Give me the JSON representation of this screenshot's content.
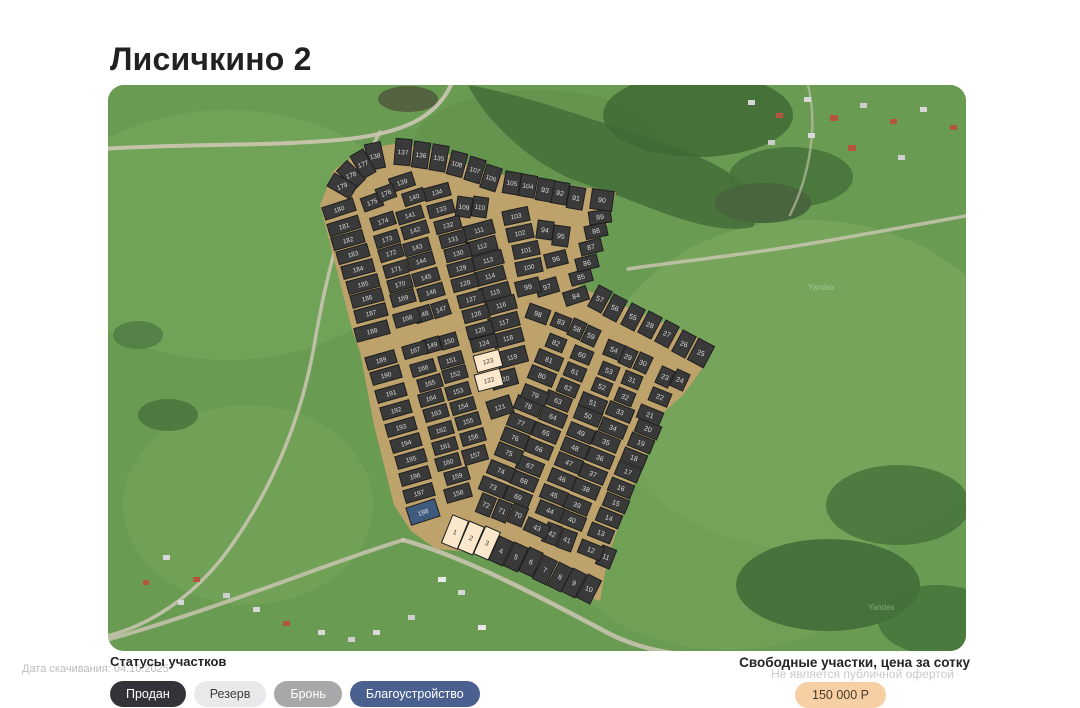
{
  "page": {
    "title": "Лисичкино 2"
  },
  "footer": {
    "download_date_label": "Дата скачивания: 04.10.2025",
    "legend_title": "Статусы участков",
    "statuses": [
      {
        "id": "sold",
        "label": "Продан",
        "bg": "#333339",
        "fg": "#ffffff"
      },
      {
        "id": "reserve",
        "label": "Резерв",
        "bg": "#e9e9ec",
        "fg": "#3c3c3c"
      },
      {
        "id": "hold",
        "label": "Бронь",
        "bg": "#a8a8aa",
        "fg": "#ffffff"
      },
      {
        "id": "improvement",
        "label": "Благоустройство",
        "bg": "#4a6190",
        "fg": "#ffffff"
      }
    ],
    "price_title": "Свободные участки, цена за сотку",
    "price_disclaimer": "Не является публичной офертой",
    "price_badge": "150 000 Р",
    "price_badge_bg": "#f6d0a4"
  },
  "map": {
    "watermark": "Yandex",
    "colors": {
      "road": "#bda26c",
      "stroke": "#1f1f1f",
      "sold": "#3a3a3b",
      "sold_text": "#dcdcdc",
      "free": "#fbe8cc",
      "free_text": "#433d33",
      "improvement": "#3e5a7c",
      "improvement_text": "#dde4ee"
    },
    "free_plots": [
      1,
      2,
      3,
      122,
      123
    ],
    "improvement_plots": [
      198
    ],
    "outline": "212,120 226,85 256,64 292,58 348,71 365,84 390,89 508,107 500,139 475,178 471,204 484,207 602,258 596,281 576,309 554,329 526,398 500,471 492,516 465,507 385,474 374,468 328,464 303,446 286,420 266,340 252,267 245,248",
    "plots": [
      [
        1,
        347,
        447,
        22,
        17,
        30
      ],
      [
        2,
        363,
        453,
        23,
        16,
        30
      ],
      [
        3,
        379,
        458,
        24,
        16,
        30
      ],
      [
        4,
        393,
        466,
        25,
        15,
        26
      ],
      [
        5,
        408,
        472,
        25,
        15,
        26
      ],
      [
        6,
        423,
        477,
        25,
        15,
        26
      ],
      [
        7,
        437,
        485,
        26,
        15,
        26
      ],
      [
        8,
        452,
        492,
        27,
        15,
        26
      ],
      [
        9,
        466,
        498,
        27,
        15,
        26
      ],
      [
        10,
        481,
        504,
        27,
        15,
        26
      ],
      [
        11,
        498,
        472,
        22,
        15,
        20
      ],
      [
        12,
        483,
        465,
        22,
        24,
        14
      ],
      [
        13,
        493,
        448,
        22,
        24,
        14
      ],
      [
        14,
        501,
        433,
        22,
        24,
        14
      ],
      [
        15,
        508,
        418,
        22,
        24,
        14
      ],
      [
        16,
        513,
        403,
        22,
        24,
        14
      ],
      [
        17,
        520,
        387,
        22,
        24,
        14
      ],
      [
        18,
        526,
        373,
        22,
        24,
        14
      ],
      [
        19,
        533,
        358,
        22,
        24,
        14
      ],
      [
        20,
        540,
        344,
        22,
        24,
        14
      ],
      [
        21,
        542,
        330,
        22,
        24,
        14
      ],
      [
        22,
        552,
        312,
        22,
        20,
        14
      ],
      [
        23,
        557,
        292,
        25,
        14,
        18
      ],
      [
        24,
        572,
        295,
        25,
        14,
        18
      ],
      [
        25,
        593,
        268,
        28,
        18,
        24
      ],
      [
        26,
        576,
        259,
        28,
        15,
        24
      ],
      [
        27,
        559,
        249,
        28,
        15,
        24
      ],
      [
        28,
        542,
        240,
        28,
        15,
        24
      ],
      [
        29,
        520,
        272,
        25,
        14,
        18
      ],
      [
        30,
        535,
        278,
        25,
        14,
        18
      ],
      [
        31,
        524,
        295,
        22,
        18,
        14
      ],
      [
        32,
        517,
        312,
        22,
        18,
        14
      ],
      [
        33,
        512,
        327,
        22,
        26,
        14
      ],
      [
        34,
        505,
        343,
        22,
        26,
        14
      ],
      [
        35,
        498,
        357,
        22,
        26,
        14
      ],
      [
        36,
        492,
        373,
        22,
        26,
        14
      ],
      [
        37,
        485,
        389,
        22,
        26,
        14
      ],
      [
        38,
        478,
        404,
        22,
        26,
        14
      ],
      [
        39,
        469,
        420,
        22,
        26,
        14
      ],
      [
        40,
        464,
        435,
        22,
        26,
        14
      ],
      [
        41,
        459,
        455,
        20,
        15,
        20
      ],
      [
        42,
        444,
        449,
        20,
        15,
        20
      ],
      [
        43,
        429,
        443,
        24,
        24,
        14
      ],
      [
        44,
        442,
        426,
        22,
        26,
        14
      ],
      [
        45,
        446,
        410,
        22,
        26,
        14
      ],
      [
        46,
        454,
        394,
        22,
        26,
        14
      ],
      [
        47,
        461,
        378,
        22,
        26,
        14
      ],
      [
        48,
        467,
        363,
        22,
        26,
        14
      ],
      [
        49,
        473,
        348,
        22,
        26,
        14
      ],
      [
        50,
        480,
        331,
        22,
        26,
        14
      ],
      [
        51,
        485,
        318,
        22,
        26,
        14
      ],
      [
        52,
        494,
        302,
        22,
        18,
        14
      ],
      [
        53,
        501,
        286,
        22,
        18,
        14
      ],
      [
        54,
        506,
        265,
        22,
        18,
        16
      ],
      [
        55,
        525,
        232,
        28,
        15,
        24
      ],
      [
        56,
        507,
        223,
        28,
        15,
        24
      ],
      [
        57,
        492,
        214,
        28,
        15,
        24
      ],
      [
        58,
        469,
        244,
        25,
        14,
        18
      ],
      [
        59,
        483,
        251,
        25,
        14,
        18
      ],
      [
        60,
        474,
        270,
        22,
        20,
        14
      ],
      [
        61,
        467,
        287,
        22,
        20,
        14
      ],
      [
        62,
        460,
        303,
        22,
        20,
        14
      ],
      [
        63,
        450,
        316,
        22,
        26,
        14
      ],
      [
        64,
        445,
        332,
        22,
        26,
        14
      ],
      [
        65,
        438,
        348,
        22,
        26,
        14
      ],
      [
        66,
        431,
        364,
        22,
        26,
        14
      ],
      [
        67,
        422,
        381,
        22,
        26,
        14
      ],
      [
        68,
        416,
        396,
        22,
        26,
        14
      ],
      [
        69,
        410,
        412,
        22,
        26,
        14
      ],
      [
        70,
        410,
        430,
        22,
        15,
        20
      ],
      [
        71,
        394,
        426,
        22,
        15,
        20
      ],
      [
        72,
        378,
        420,
        22,
        15,
        20
      ],
      [
        73,
        385,
        402,
        22,
        26,
        14
      ],
      [
        74,
        393,
        386,
        22,
        26,
        14
      ],
      [
        75,
        401,
        368,
        22,
        26,
        14
      ],
      [
        76,
        407,
        353,
        22,
        26,
        14
      ],
      [
        77,
        413,
        338,
        22,
        26,
        14
      ],
      [
        78,
        420,
        321,
        22,
        26,
        14
      ],
      [
        79,
        427,
        310,
        22,
        26,
        14
      ],
      [
        80,
        434,
        291,
        22,
        26,
        14
      ],
      [
        81,
        441,
        275,
        22,
        26,
        14
      ],
      [
        82,
        448,
        258,
        22,
        18,
        14
      ],
      [
        83,
        453,
        237,
        22,
        18,
        14
      ],
      [
        84,
        468,
        211,
        -18,
        24,
        14
      ],
      [
        85,
        473,
        192,
        -16,
        22,
        13
      ],
      [
        86,
        479,
        178,
        -14,
        22,
        13
      ],
      [
        87,
        483,
        162,
        -14,
        22,
        13
      ],
      [
        88,
        488,
        146,
        -12,
        22,
        13
      ],
      [
        89,
        492,
        132,
        -8,
        22,
        13
      ],
      [
        90,
        494,
        115,
        8,
        22,
        20
      ],
      [
        91,
        468,
        113,
        10,
        16,
        22
      ],
      [
        92,
        452,
        108,
        10,
        16,
        22
      ],
      [
        93,
        437,
        105,
        10,
        16,
        22
      ],
      [
        94,
        437,
        145,
        8,
        16,
        18
      ],
      [
        95,
        453,
        151,
        8,
        16,
        20
      ],
      [
        96,
        448,
        174,
        -14,
        22,
        14
      ],
      [
        97,
        439,
        202,
        -16,
        22,
        15
      ],
      [
        98,
        430,
        229,
        20,
        22,
        15
      ],
      [
        99,
        420,
        202,
        -14,
        24,
        15
      ],
      [
        100,
        421,
        182,
        -12,
        26,
        14
      ],
      [
        101,
        418,
        165,
        -12,
        26,
        14
      ],
      [
        102,
        412,
        148,
        -12,
        26,
        14
      ],
      [
        103,
        408,
        131,
        -12,
        26,
        14
      ],
      [
        104,
        420,
        101,
        10,
        16,
        22
      ],
      [
        105,
        404,
        98,
        10,
        16,
        22
      ],
      [
        106,
        383,
        93,
        18,
        16,
        24
      ],
      [
        107,
        367,
        85,
        17,
        16,
        24
      ],
      [
        108,
        349,
        79,
        15,
        16,
        24
      ],
      [
        109,
        356,
        122,
        8,
        15,
        20
      ],
      [
        110,
        372,
        122,
        8,
        15,
        20
      ],
      [
        111,
        371,
        145,
        -15,
        30,
        14
      ],
      [
        112,
        374,
        161,
        -15,
        30,
        14
      ],
      [
        113,
        380,
        175,
        -15,
        30,
        14
      ],
      [
        114,
        382,
        191,
        -15,
        30,
        14
      ],
      [
        115,
        387,
        207,
        -15,
        30,
        14
      ],
      [
        116,
        393,
        220,
        -15,
        30,
        14
      ],
      [
        117,
        396,
        237,
        -15,
        30,
        14
      ],
      [
        118,
        400,
        253,
        -15,
        30,
        14
      ],
      [
        119,
        404,
        272,
        -15,
        30,
        16
      ],
      [
        120,
        396,
        294,
        -15,
        26,
        16
      ],
      [
        121,
        392,
        322,
        -18,
        24,
        18
      ],
      [
        122,
        381,
        295,
        -15,
        26,
        17
      ],
      [
        123,
        380,
        276,
        -15,
        26,
        17
      ],
      [
        124,
        376,
        258,
        -15,
        26,
        13
      ],
      [
        125,
        372,
        245,
        -15,
        26,
        13
      ],
      [
        126,
        368,
        229,
        -15,
        26,
        13
      ],
      [
        127,
        363,
        214,
        -15,
        26,
        13
      ],
      [
        128,
        357,
        198,
        -15,
        26,
        13
      ],
      [
        129,
        353,
        183,
        -15,
        26,
        13
      ],
      [
        130,
        350,
        168,
        -15,
        26,
        13
      ],
      [
        131,
        345,
        154,
        -15,
        26,
        13
      ],
      [
        132,
        340,
        140,
        -15,
        26,
        13
      ],
      [
        133,
        333,
        124,
        -15,
        26,
        13
      ],
      [
        134,
        329,
        107,
        -15,
        26,
        13
      ],
      [
        135,
        331,
        73,
        10,
        16,
        26
      ],
      [
        136,
        313,
        70,
        8,
        16,
        26
      ],
      [
        137,
        295,
        67,
        5,
        16,
        26
      ],
      [
        138,
        267,
        71,
        -12,
        16,
        26
      ],
      [
        139,
        294,
        97,
        -18,
        24,
        14
      ],
      [
        140,
        306,
        112,
        -18,
        22,
        13
      ],
      [
        141,
        302,
        130,
        -17,
        26,
        13
      ],
      [
        142,
        307,
        145,
        -17,
        26,
        13
      ],
      [
        143,
        309,
        162,
        -16,
        26,
        13
      ],
      [
        144,
        313,
        176,
        -16,
        26,
        13
      ],
      [
        145,
        318,
        192,
        -16,
        26,
        13
      ],
      [
        146,
        323,
        207,
        -16,
        26,
        13
      ],
      [
        147,
        333,
        224,
        -18,
        17,
        15
      ],
      [
        148,
        315,
        229,
        -18,
        17,
        15
      ],
      [
        149,
        324,
        260,
        -16,
        17,
        14
      ],
      [
        150,
        341,
        256,
        -16,
        17,
        14
      ],
      [
        151,
        343,
        275,
        -16,
        24,
        13
      ],
      [
        152,
        347,
        289,
        -16,
        24,
        13
      ],
      [
        153,
        350,
        306,
        -16,
        24,
        13
      ],
      [
        154,
        355,
        321,
        -16,
        24,
        13
      ],
      [
        155,
        360,
        336,
        -16,
        24,
        13
      ],
      [
        156,
        365,
        352,
        -16,
        24,
        13
      ],
      [
        157,
        367,
        370,
        -16,
        24,
        15
      ],
      [
        158,
        350,
        408,
        -16,
        26,
        14
      ],
      [
        159,
        349,
        391,
        -16,
        24,
        13
      ],
      [
        160,
        340,
        377,
        -16,
        24,
        13
      ],
      [
        161,
        337,
        361,
        -16,
        24,
        13
      ],
      [
        162,
        333,
        345,
        -16,
        24,
        13
      ],
      [
        163,
        328,
        328,
        -16,
        24,
        13
      ],
      [
        164,
        323,
        313,
        -16,
        24,
        13
      ],
      [
        165,
        322,
        298,
        -16,
        24,
        13
      ],
      [
        166,
        315,
        283,
        -16,
        24,
        13
      ],
      [
        167,
        307,
        265,
        -16,
        24,
        13
      ],
      [
        168,
        299,
        233,
        -16,
        26,
        14
      ],
      [
        169,
        295,
        213,
        -16,
        24,
        13
      ],
      [
        170,
        292,
        199,
        -16,
        24,
        13
      ],
      [
        171,
        288,
        184,
        -16,
        24,
        13
      ],
      [
        172,
        283,
        168,
        -17,
        24,
        13
      ],
      [
        173,
        279,
        154,
        -17,
        24,
        13
      ],
      [
        174,
        275,
        136,
        -18,
        24,
        13
      ],
      [
        175,
        264,
        117,
        -20,
        20,
        14
      ],
      [
        176,
        278,
        108,
        -20,
        18,
        14
      ],
      [
        177,
        255,
        79,
        -30,
        15,
        26
      ],
      [
        178,
        243,
        90,
        -45,
        15,
        26
      ],
      [
        179,
        234,
        101,
        -60,
        15,
        26
      ],
      [
        180,
        231,
        124,
        -18,
        32,
        13
      ],
      [
        181,
        236,
        141,
        -17,
        32,
        13
      ],
      [
        182,
        240,
        155,
        -16,
        32,
        13
      ],
      [
        183,
        245,
        169,
        -16,
        32,
        13
      ],
      [
        184,
        250,
        184,
        -15,
        32,
        13
      ],
      [
        185,
        255,
        199,
        -15,
        32,
        13
      ],
      [
        186,
        259,
        213,
        -15,
        32,
        13
      ],
      [
        187,
        263,
        228,
        -15,
        32,
        13
      ],
      [
        188,
        264,
        246,
        -15,
        34,
        14
      ],
      [
        189,
        273,
        275,
        -16,
        30,
        13
      ],
      [
        190,
        278,
        290,
        -16,
        30,
        13
      ],
      [
        191,
        283,
        308,
        -16,
        30,
        13
      ],
      [
        192,
        288,
        325,
        -16,
        30,
        13
      ],
      [
        193,
        293,
        342,
        -16,
        30,
        13
      ],
      [
        194,
        298,
        358,
        -16,
        30,
        13
      ],
      [
        195,
        303,
        374,
        -16,
        30,
        13
      ],
      [
        196,
        307,
        391,
        -16,
        30,
        13
      ],
      [
        197,
        311,
        408,
        -16,
        30,
        13
      ],
      [
        198,
        315,
        427,
        -18,
        30,
        18
      ]
    ]
  }
}
